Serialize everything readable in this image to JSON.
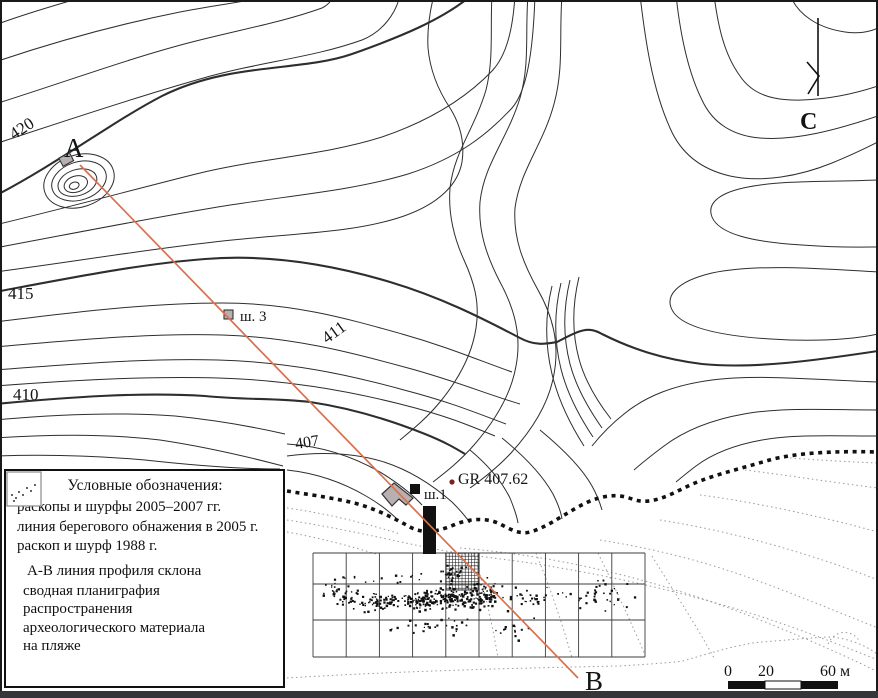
{
  "labels": {
    "point_a": "А",
    "point_b": "В",
    "north": "С",
    "elev_420": "420",
    "elev_415": "415",
    "elev_410": "410",
    "elev_411": "411",
    "elev_407": "407",
    "test_pit_3": "ш. 3",
    "test_pit_1": "ш.1",
    "gr_point": "GR 407.62"
  },
  "legend": {
    "title": "Условные обозначения:",
    "items": [
      {
        "icon": "excavation-2005-2007-icon",
        "label": "раскопы и шурфы 2005–2007 гг."
      },
      {
        "icon": "shore-exposure-line-icon",
        "label": "линия берегового обнажения в 2005 г."
      },
      {
        "icon": "excavation-1988-icon",
        "label": "раскоп и шурф 1988 г."
      },
      {
        "icon": "profile-line-icon",
        "label": "А-В линия профиля склона"
      },
      {
        "icon": "planigraphy-icon",
        "label": "сводная планиграфия распространения археологического материала на пляже"
      }
    ]
  },
  "scale_bar": {
    "tick0": "0",
    "tick20": "20",
    "tick60": "60 м"
  },
  "colors": {
    "profile_line": "#d9714f",
    "excavation_fill": "#b8b0b0",
    "gr_dot": "#77231f",
    "contour": "#2e2e2e",
    "light_contour": "#9a9a9a",
    "grid_line": "#3c3c3c"
  },
  "scatter_clusters": [
    {
      "cx": 455,
      "cy": 597,
      "sx": 28,
      "sy": 9,
      "n": 160
    },
    {
      "cx": 420,
      "cy": 600,
      "sx": 18,
      "sy": 8,
      "n": 80
    },
    {
      "cx": 380,
      "cy": 602,
      "sx": 22,
      "sy": 9,
      "n": 60
    },
    {
      "cx": 345,
      "cy": 596,
      "sx": 14,
      "sy": 8,
      "n": 30
    },
    {
      "cx": 490,
      "cy": 592,
      "sx": 18,
      "sy": 10,
      "n": 50
    },
    {
      "cx": 452,
      "cy": 572,
      "sx": 10,
      "sy": 9,
      "n": 30
    },
    {
      "cx": 530,
      "cy": 598,
      "sx": 15,
      "sy": 9,
      "n": 25
    },
    {
      "cx": 585,
      "cy": 598,
      "sx": 22,
      "sy": 9,
      "n": 20
    },
    {
      "cx": 620,
      "cy": 600,
      "sx": 15,
      "sy": 10,
      "n": 10
    },
    {
      "cx": 430,
      "cy": 626,
      "sx": 45,
      "sy": 8,
      "n": 28
    },
    {
      "cx": 520,
      "cy": 630,
      "sx": 25,
      "sy": 8,
      "n": 14
    },
    {
      "cx": 330,
      "cy": 588,
      "sx": 10,
      "sy": 5,
      "n": 8
    },
    {
      "cx": 400,
      "cy": 577,
      "sx": 30,
      "sy": 6,
      "n": 10
    },
    {
      "cx": 350,
      "cy": 580,
      "sx": 20,
      "sy": 5,
      "n": 6
    },
    {
      "cx": 610,
      "cy": 585,
      "sx": 20,
      "sy": 6,
      "n": 8
    }
  ]
}
